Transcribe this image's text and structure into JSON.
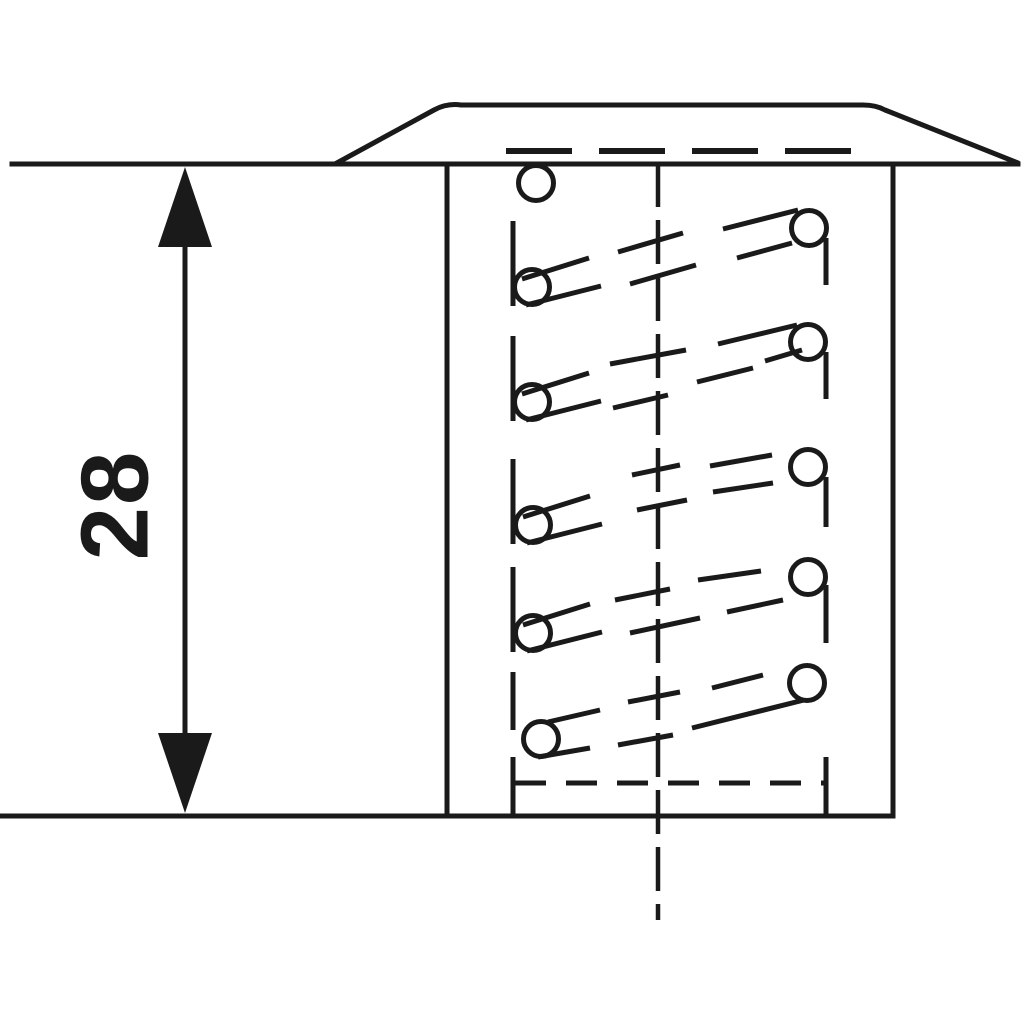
{
  "meta": {
    "description": "Sectional technical drawing of a wire thread insert in a tapped hole with depth dimension"
  },
  "dimension": {
    "label": "28"
  },
  "colors": {
    "ink": "#1a1a1a",
    "background": "#ffffff"
  },
  "drawing": {
    "canvas": {
      "w": 1024,
      "h": 1024
    },
    "stroke_width": 5,
    "outline": {
      "surface_line": [
        12,
        164,
        1018,
        164
      ],
      "bottom_line": [
        2,
        816,
        893,
        816
      ],
      "body_left": [
        447,
        164,
        447,
        816
      ],
      "body_right": [
        893,
        164,
        893,
        816
      ],
      "flange_path": "M 335 164 L 434 110 Q 447 103 461 105 L 863 105 Q 876 105 885 110 L 1018 163"
    },
    "dashed_lines": [
      {
        "name": "flange-hidden-line",
        "x1": 506,
        "y1": 151,
        "x2": 852,
        "y2": 151,
        "dash": "66 27",
        "width": 6
      },
      {
        "name": "hole-bottom-hidden-line",
        "x1": 515,
        "y1": 783,
        "x2": 825,
        "y2": 783,
        "dash": "31 20",
        "width": 5
      },
      {
        "name": "centerline",
        "x1": 658,
        "y1": 163,
        "x2": 658,
        "y2": 920,
        "dash": "44 13",
        "width": 4.5
      }
    ],
    "coil": {
      "circle_r": 17.5,
      "top_circle": [
        536,
        183
      ],
      "rows": [
        {
          "left_circle": [
            532,
            287
          ],
          "right_circle": [
            809,
            228
          ],
          "solid": [
            [
              513,
              221,
              513,
              306
            ],
            [
              522,
              279,
              589,
              258
            ],
            [
              526,
              305,
              601,
              286
            ],
            [
              723,
              229,
              798,
              210
            ],
            [
              737,
              258,
              792,
              243
            ],
            [
              826,
              238,
              826,
              285
            ]
          ],
          "hidden": [
            [
              618,
              252,
              683,
              233
            ],
            [
              630,
              284,
              696,
              265
            ]
          ]
        },
        {
          "left_circle": [
            532,
            402
          ],
          "right_circle": [
            808,
            342
          ],
          "solid": [
            [
              513,
              336,
              513,
              421
            ],
            [
              522,
              394,
              589,
              373
            ],
            [
              526,
              420,
              601,
              401
            ],
            [
              718,
              344,
              797,
              325
            ],
            [
              765,
              361,
              802,
              350
            ],
            [
              826,
              352,
              826,
              399
            ]
          ],
          "hidden": [
            [
              610,
              364,
              686,
              350
            ],
            [
              613,
              408,
              668,
              395
            ],
            [
              697,
              382,
              753,
              368
            ]
          ]
        },
        {
          "left_circle": [
            533,
            525
          ],
          "right_circle": [
            808,
            467
          ],
          "solid": [
            [
              513,
              459,
              513,
              544
            ],
            [
              523,
              517,
              590,
              496
            ],
            [
              527,
              543,
              602,
              524
            ],
            [
              826,
              477,
              826,
              527
            ]
          ],
          "hidden": [
            [
              632,
              475,
              680,
              465
            ],
            [
              637,
              510,
              687,
              500
            ],
            [
              710,
              466,
              772,
              455
            ],
            [
              713,
              492,
              773,
              483
            ]
          ]
        },
        {
          "left_circle": [
            533,
            633
          ],
          "right_circle": [
            808,
            577
          ],
          "solid": [
            [
              513,
              567,
              513,
              652
            ],
            [
              523,
              625,
              590,
              604
            ],
            [
              527,
              651,
              602,
              632
            ],
            [
              826,
              585,
              826,
              643
            ]
          ],
          "hidden": [
            [
              615,
              600,
              670,
              589
            ],
            [
              630,
              633,
              700,
              618
            ],
            [
              698,
              580,
              761,
              571
            ],
            [
              727,
              612,
              783,
              600
            ]
          ]
        },
        {
          "left_circle": [
            541,
            739
          ],
          "right_circle": [
            807,
            683
          ],
          "solid": [
            [
              513,
              672,
              513,
              730
            ],
            [
              513,
              757,
              513,
              815
            ],
            [
              548,
              722,
              600,
              710
            ],
            [
              538,
              757,
              590,
              748
            ],
            [
              692,
              728,
              804,
              700
            ],
            [
              826,
              757,
              826,
              815
            ]
          ],
          "hidden": [
            [
              628,
              702,
              680,
              692
            ],
            [
              618,
              745,
              673,
              735
            ],
            [
              712,
              688,
              763,
              675
            ]
          ]
        }
      ]
    },
    "dimension_geo": {
      "shaft": [
        185,
        242,
        185,
        738
      ],
      "arrow_top": "185,167 158,247 212,247",
      "arrow_bottom": "185,813 158,733 212,733",
      "label_pos": [
        115,
        505
      ],
      "label_font_size": 96
    }
  }
}
